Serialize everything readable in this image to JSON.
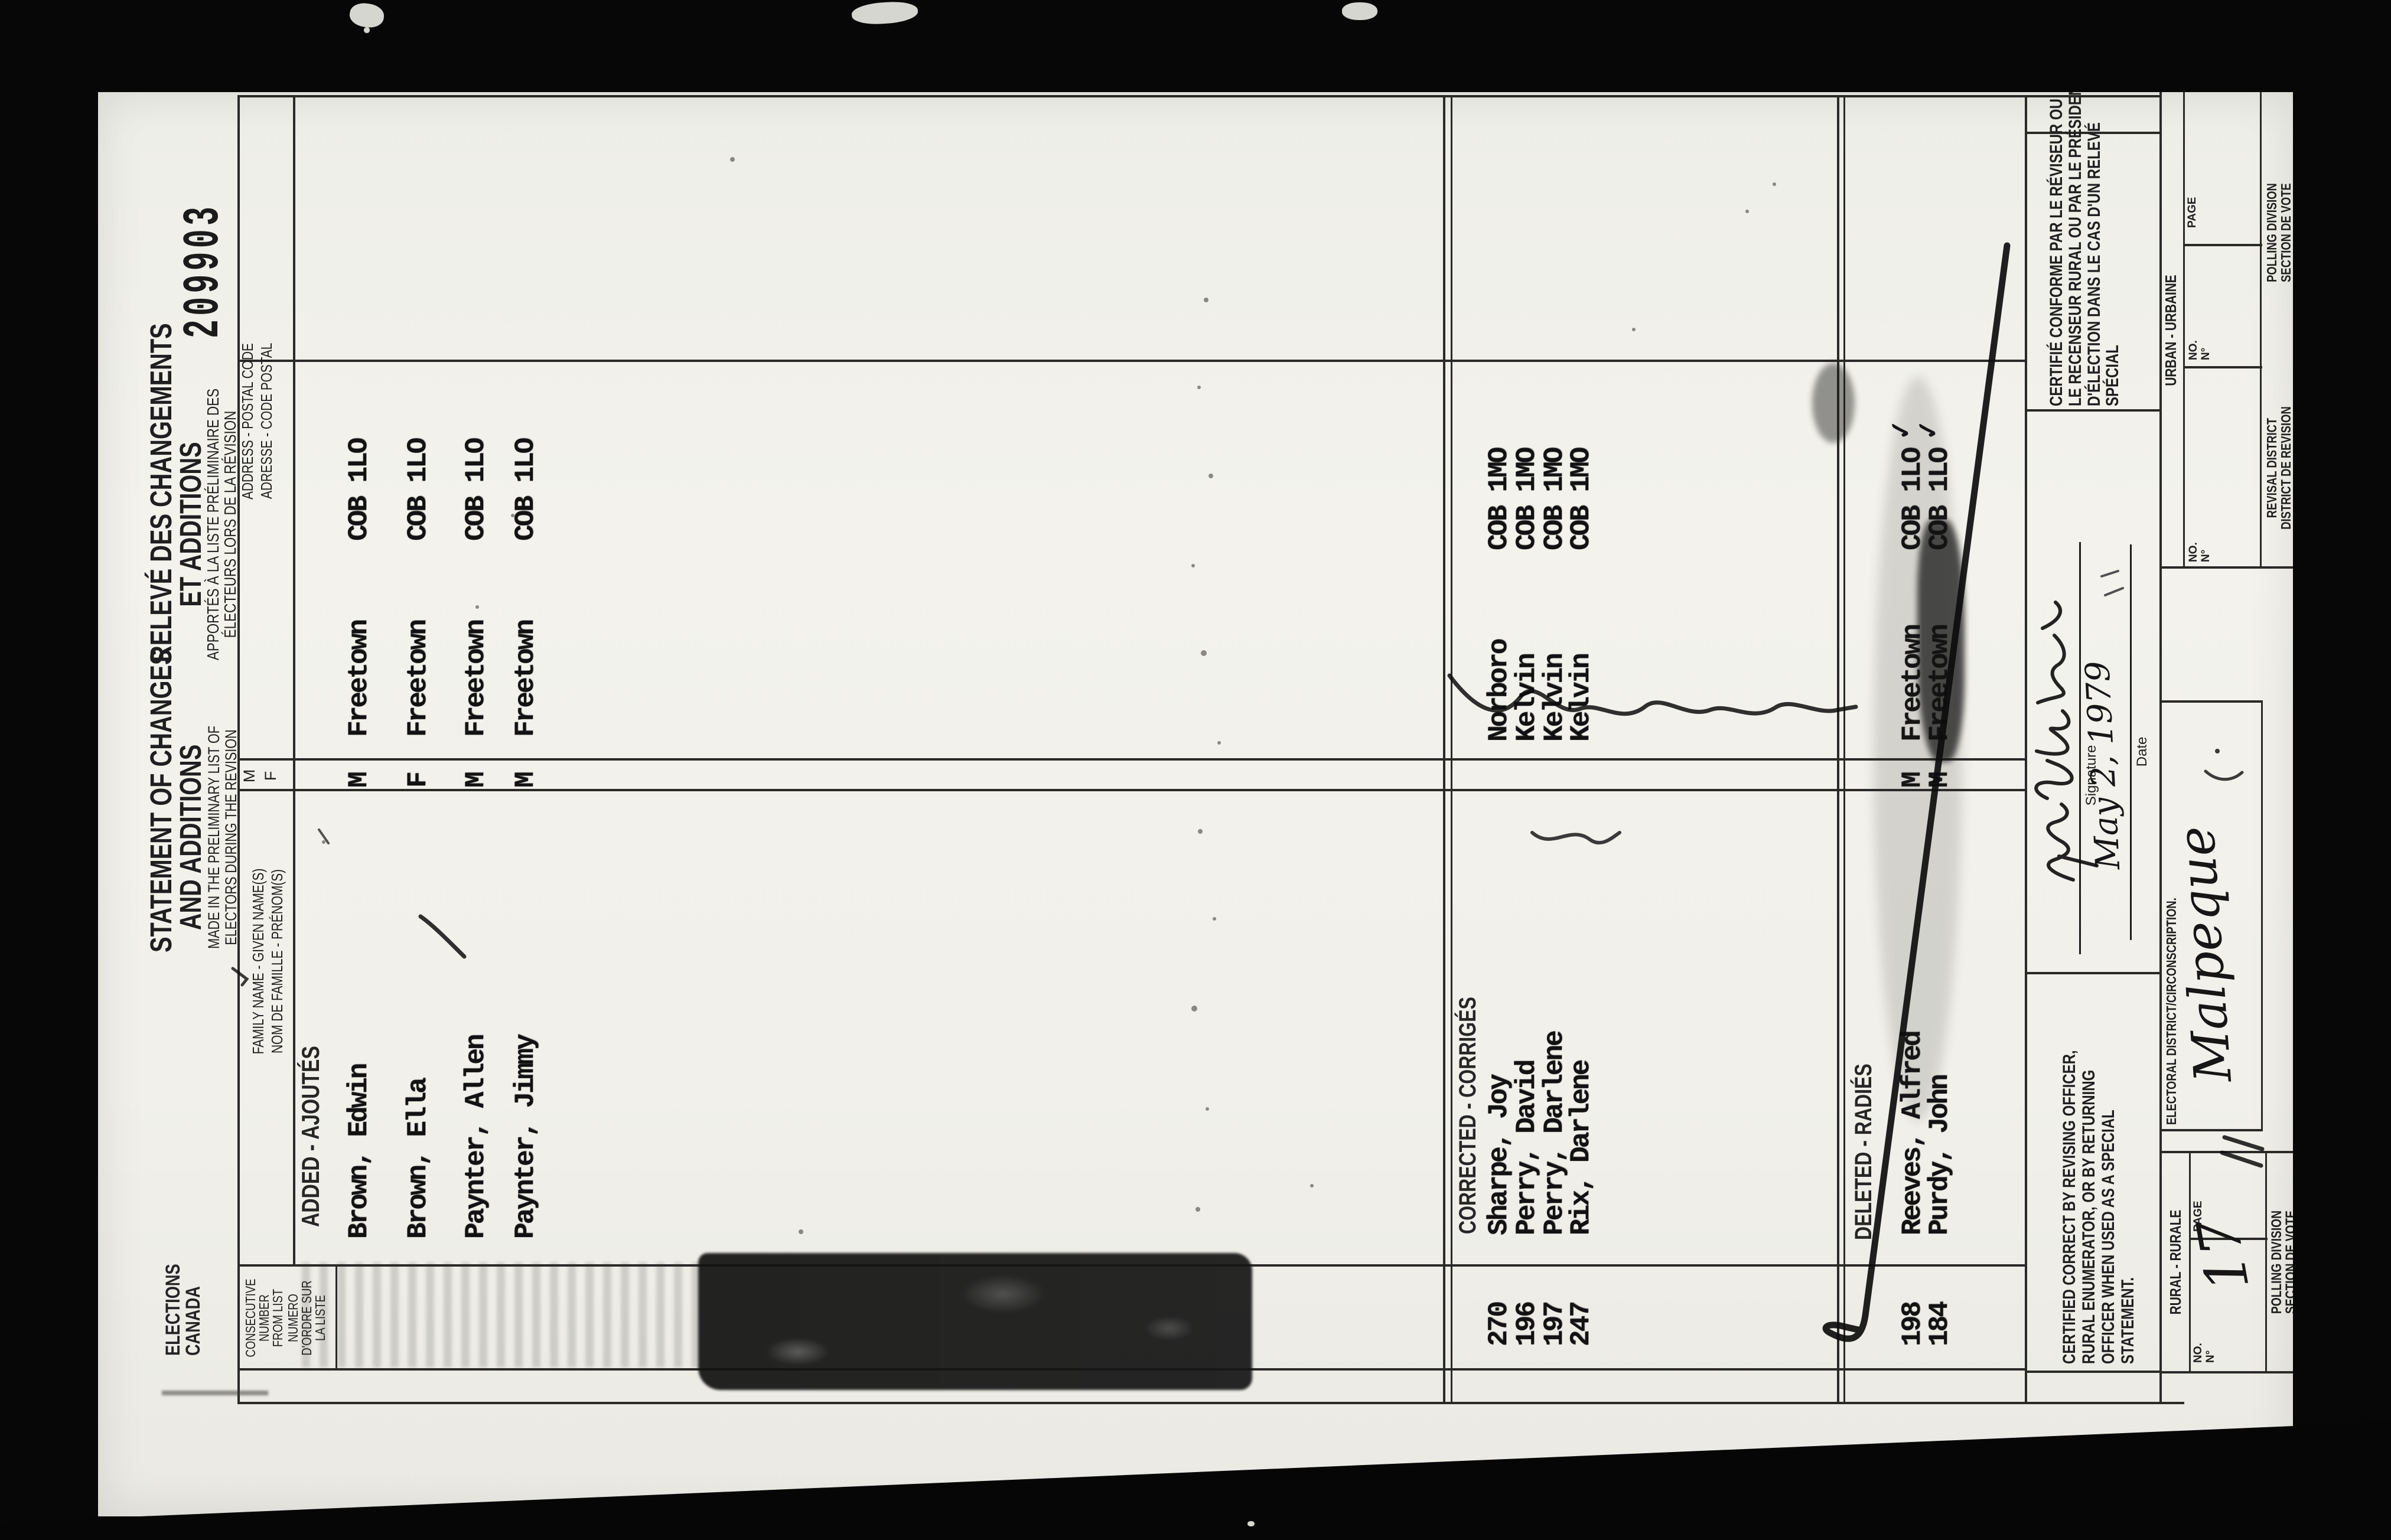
{
  "scan": {
    "serial": "209903"
  },
  "logo": {
    "line1": "ELECTIONS",
    "line2": "CANADA"
  },
  "title_en": {
    "l1": "STATEMENT OF CHANGES",
    "l2": "AND ADDITIONS",
    "s1": "MADE IN THE PRELIMINARY LIST OF",
    "s2": "ELECTORS DURING THE REVISION"
  },
  "title_fr": {
    "l1": "RELEVÉ DES CHANGEMENTS",
    "l2": "ET ADDITIONS",
    "s1": "APPORTÉS À LA LISTE PRÉLIMINAIRE DES",
    "s2": "ÉLECTEURS LORS DE LA RÉVISION"
  },
  "columns": {
    "consecutive_en": [
      "CONSECUTIVE",
      "NUMBER",
      "FROM LIST"
    ],
    "consecutive_fr": [
      "NUMERO",
      "D'ORDRE SUR",
      "LA LISTE"
    ],
    "name_en": "FAMILY NAME - GIVEN NAME(S)",
    "name_fr": "NOM DE FAMILLE - PRÉNOM(S)",
    "sex_m": "M",
    "sex_f": "F",
    "address_en": "ADDRESS - POSTAL CODE",
    "address_fr": "ADRESSE - CODE POSTAL"
  },
  "sections": {
    "added": {
      "label": "ADDED - AJOUTÉS",
      "rows": [
        {
          "name": "Brown, Edwin",
          "sex": "M",
          "community": "Freetown",
          "postal": "COB 1LO"
        },
        {
          "name": "Brown, Ella",
          "sex": "F",
          "community": "Freetown",
          "postal": "COB 1LO"
        },
        {
          "name": "Paynter, Allen",
          "sex": "M",
          "community": "Freetown",
          "postal": "COB 1LO"
        },
        {
          "name": "Paynter, Jimmy",
          "sex": "M",
          "community": "Freetown",
          "postal": "COB 1LO"
        }
      ]
    },
    "corrected": {
      "label": "CORRECTED - CORRIGÉS",
      "rows": [
        {
          "number": "270",
          "name": "Sharpe, Joy",
          "community": "Norboro",
          "postal": "COB 1MO"
        },
        {
          "number": "196",
          "name": "Perry, David",
          "community": "Kelvin",
          "postal": "COB 1MO"
        },
        {
          "number": "197",
          "name": "Perry, Darlene",
          "community": "Kelvin",
          "postal": "COB 1MO"
        },
        {
          "number": "247",
          "name": "Rix, Darlene",
          "community": "Kelvin",
          "postal": "COB 1MO"
        }
      ]
    },
    "deleted": {
      "label": "DELETED - RADIÉS",
      "rows": [
        {
          "number": "198",
          "name": "Reeves, Alfred",
          "sex": "M",
          "community": "Freetown",
          "postal": "COB 1LO",
          "check": "✓"
        },
        {
          "number": "184",
          "name": "Purdy, John",
          "sex": "M",
          "community": "Freetown",
          "postal": "COB 1LO",
          "check": "✓"
        }
      ]
    }
  },
  "certification": {
    "en": [
      "CERTIFIED CORRECT BY REVISING OFFICER,",
      "RURAL ENUMERATOR, OR BY RETURNING",
      "OFFICER WHEN USED AS A SPECIAL",
      "STATEMENT."
    ],
    "fr": [
      "CERTIFIÉ CONFORME PAR LE RÉVISEUR OU",
      "LE RECENSEUR RURAL OU PAR LE PRÉSIDENT",
      "D'ÉLECTION DANS LE CAS D'UN RELEVÉ",
      "SPÉCIAL"
    ],
    "signature_label": "Signature",
    "date_label": "Date",
    "date_script": "May 2, 1979"
  },
  "footer": {
    "no_label": "NO.",
    "no_deg": "N°",
    "page_label": "PAGE",
    "rural": {
      "title": "RURAL - RURALE",
      "page_value": "17",
      "bottom1": "POLLING DIVISION",
      "bottom2": "SECTION DE VOTE"
    },
    "district": {
      "label": "ELECTORAL DISTRICT/CIRCONSCRIPTION.",
      "script": "Malpeque"
    },
    "urban": {
      "title": "URBAN - URBAINE",
      "revisal1": "REVISAL DISTRICT",
      "revisal2": "DISTRICT DE REVISION",
      "polling1": "POLLING DIVISION",
      "polling2": "SECTION DE VOTE"
    }
  }
}
